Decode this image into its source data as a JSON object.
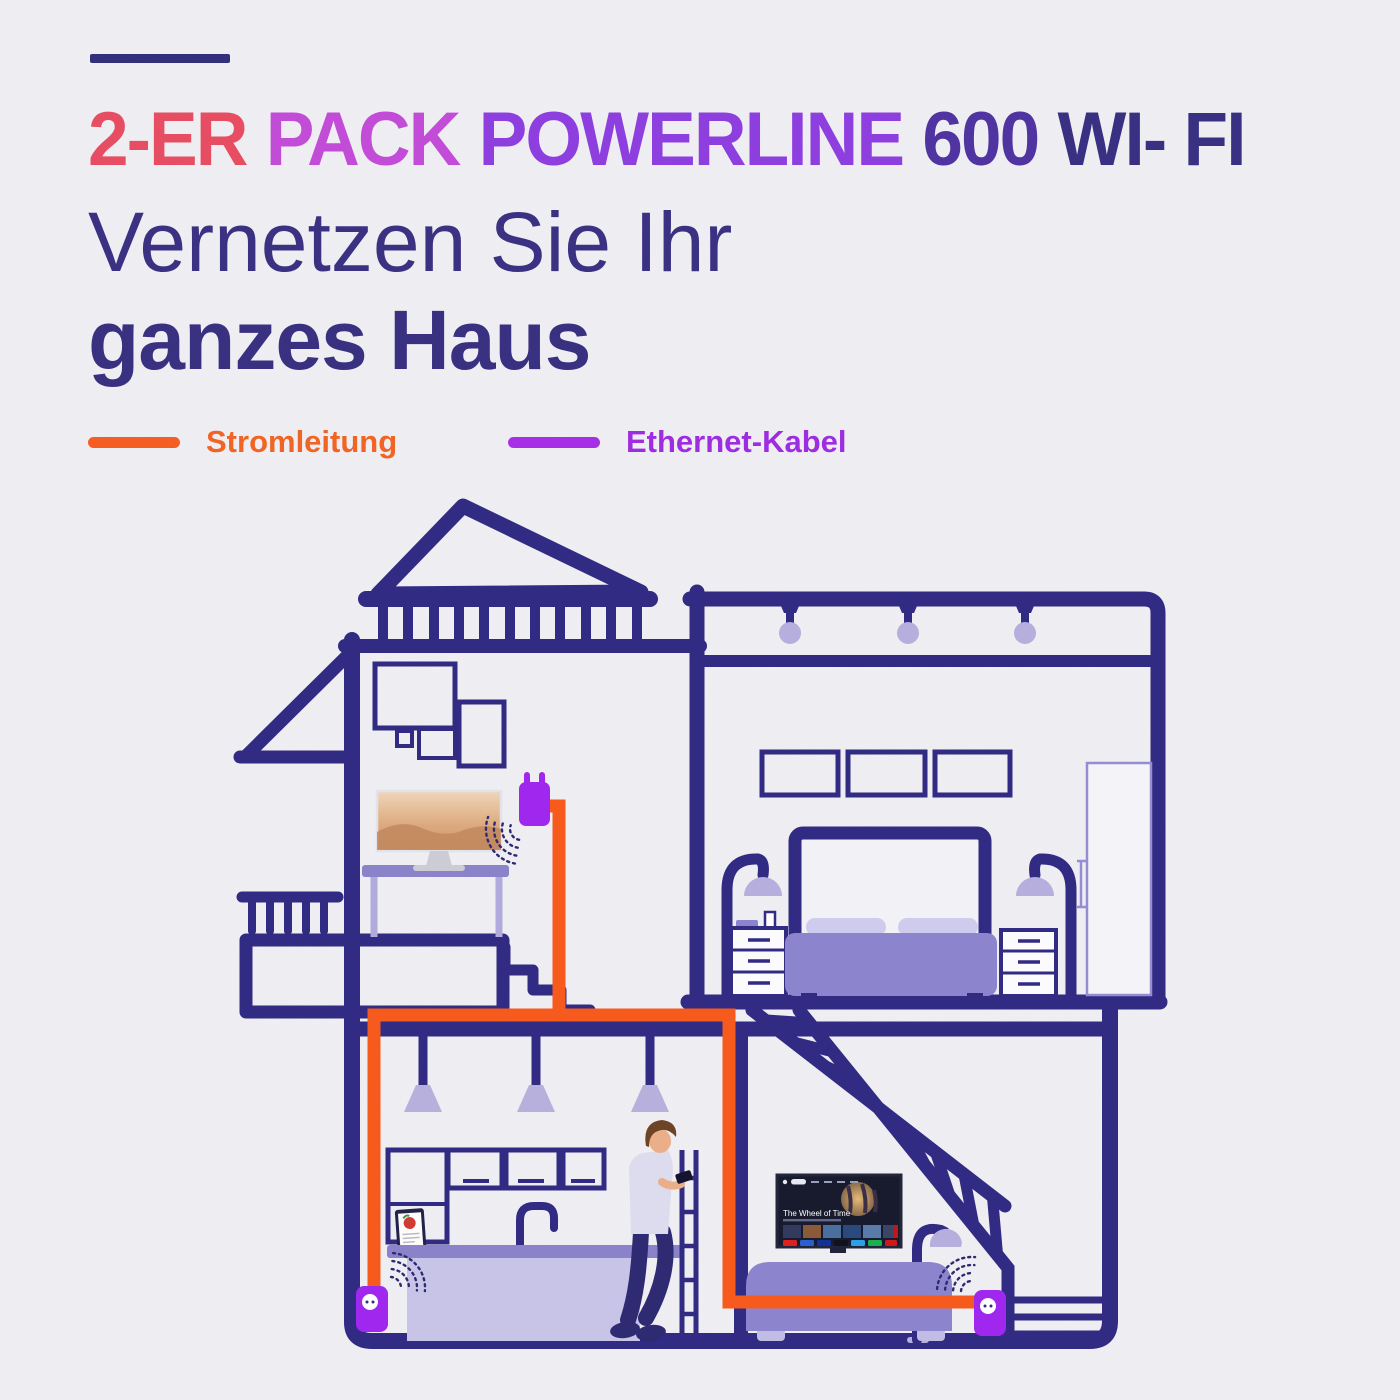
{
  "page": {
    "background": "#f0eff3"
  },
  "header": {
    "title": "2-ER PACK POWERLINE 600 WI- FI",
    "title_words": [
      {
        "text": "2-ER",
        "color": "#e8495f"
      },
      {
        "text": "PACK",
        "color": "#c248d8"
      },
      {
        "text": "POWERLINE",
        "color": "#8c3ae0"
      },
      {
        "text": "600",
        "color": "#4b2fa0"
      },
      {
        "text": "WI- FI",
        "color": "#342b80"
      }
    ],
    "subtitle_light": "Vernetzen Sie Ihr",
    "subtitle_bold": "ganzes Haus",
    "subtitle_color": "#362c80",
    "accent_dash_color": "#2e2a78"
  },
  "legend": {
    "power": {
      "label": "Stromleitung",
      "swatch_color": "#f75a1d",
      "text_color": "#f2611f"
    },
    "ethernet": {
      "label": "Ethernet-Kabel",
      "swatch_color": "#a62ae8",
      "text_color": "#9d27e2"
    }
  },
  "tv": {
    "title": "The Wheel of Time"
  },
  "palette": {
    "wall_navy": "#312b83",
    "furniture_purple": "#8c85cd",
    "furniture_light": "#c6c2e7",
    "lamp_shade": "#b6aedd",
    "powerline_orange": "#f75a1d",
    "adapter_purple": "#9f27ee"
  }
}
